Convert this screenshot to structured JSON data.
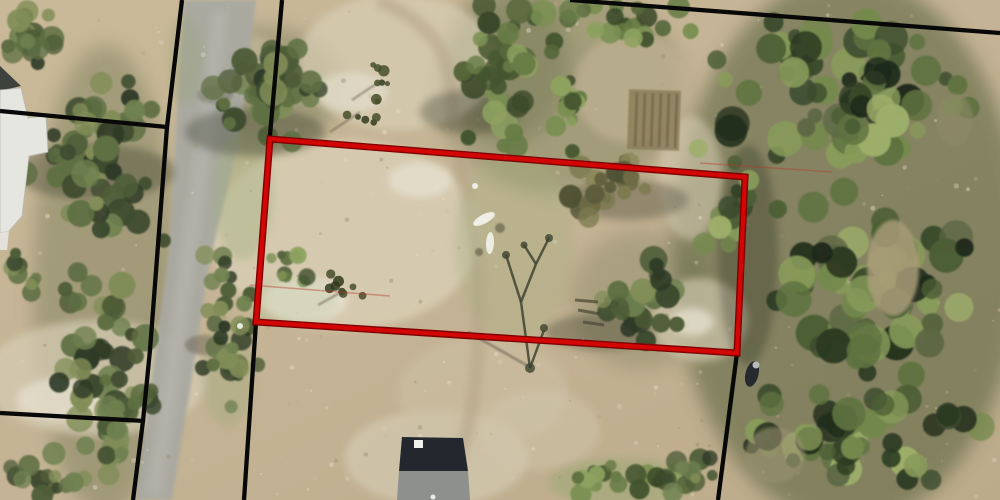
{
  "palette": {
    "P1": [
      "#2E3A26",
      "#3D4B2E",
      "#4E5D38",
      "#5E6F42",
      "#6F8150",
      "#828E58"
    ],
    "P2": [
      "#44552F",
      "#56683A",
      "#687C46",
      "#7B9052",
      "#8EA260",
      "#3A4829"
    ],
    "P3": [
      "#1F2B1B",
      "#2C3A22",
      "#3A4A2C",
      "#4C5E34",
      "#5F7340",
      "#74894C",
      "#889C5A",
      "#9DAF6A",
      "#5C6644"
    ],
    "P4": [
      "#6E6B46",
      "#7D7A50",
      "#5C5C3C",
      "#8B8658",
      "#4E5234"
    ],
    "base_stops": [
      "#C9B998",
      "#C4B394",
      "#BCAB8A"
    ],
    "road": "#A9A9A1",
    "road_stripe": "#BABAB2",
    "trail": "#B3A286",
    "black_line": "#080808",
    "red_outline": "#D40505",
    "red_outline_dark": "#7E0202",
    "thin_red": "#B53A30",
    "speckle_colors": [
      "#E7E1CF",
      "#B2A487",
      "#D9CEB5",
      "#9C9076",
      "#C8BCA0"
    ]
  },
  "map": {
    "canvas": {
      "width": 1000,
      "height": 500
    },
    "washes": [
      [
        848,
        250,
        175,
        275,
        "#4A5733",
        0.5
      ],
      [
        105,
        280,
        72,
        235,
        "#5A6640",
        0.33
      ],
      [
        560,
        90,
        125,
        105,
        "#5E6C42",
        0.32
      ],
      [
        265,
        88,
        78,
        62,
        "#50603A",
        0.3
      ],
      [
        508,
        62,
        62,
        82,
        "#4E5C38",
        0.28
      ],
      [
        640,
        300,
        70,
        70,
        "#56633C",
        0.22
      ]
    ],
    "sand_patches": [
      [
        345,
        235,
        135,
        95,
        "#DBD1B8",
        0.75
      ],
      [
        398,
        62,
        100,
        68,
        "#D8CEB5",
        0.7
      ],
      [
        96,
        378,
        112,
        58,
        "#D7CDB5",
        0.7
      ],
      [
        436,
        458,
        92,
        48,
        "#D3C9B1",
        0.7
      ],
      [
        700,
        320,
        48,
        42,
        "#D5CBB2",
        0.65
      ],
      [
        690,
        178,
        32,
        62,
        "#D2C8AF",
        0.6
      ],
      [
        483,
        392,
        85,
        55,
        "#CDC1A6",
        0.55
      ],
      [
        632,
        88,
        58,
        55,
        "#C4B596",
        0.6
      ],
      [
        305,
        300,
        42,
        22,
        "#EAE5D5",
        0.8
      ],
      [
        420,
        180,
        32,
        18,
        "#E8E3D3",
        0.7
      ],
      [
        352,
        92,
        36,
        20,
        "#E5E0CF",
        0.65
      ],
      [
        62,
        400,
        46,
        22,
        "#E7E2D1",
        0.7
      ],
      [
        692,
        322,
        22,
        14,
        "#EBE6D7",
        0.7
      ],
      [
        540,
        430,
        60,
        40,
        "#D0C5AB",
        0.5
      ],
      [
        245,
        60,
        40,
        25,
        "#CFC3A8",
        0.5
      ]
    ],
    "road": {
      "polygon": [
        [
          184,
          0
        ],
        [
          256,
          0
        ],
        [
          240,
          137
        ],
        [
          210,
          260
        ],
        [
          190,
          390
        ],
        [
          172,
          500
        ],
        [
          136,
          500
        ],
        [
          152,
          380
        ],
        [
          169,
          250
        ],
        [
          176,
          130
        ]
      ],
      "stripe_path": "M220,10 C212,90 196,200 182,300 C172,380 162,440 154,495",
      "shadow_blobs": [
        [
          205,
          345,
          20,
          10,
          "#6A6456",
          0.5
        ],
        [
          215,
          95,
          18,
          9,
          "#74705F",
          0.45
        ]
      ]
    },
    "trail": {
      "path": "M378,0 C428,22 450,48 452,96 C454,140 463,172 470,212 C478,252 481,300 478,350 C475,400 468,440 452,472"
    },
    "speckles": {
      "count": 320,
      "seed": 999,
      "rmin": 0.8,
      "rmax": 2.6,
      "opacity": 0.45
    },
    "grass": [
      [
        243,
        195,
        30,
        65,
        "#9FAF7E",
        0.4
      ],
      [
        228,
        372,
        26,
        55,
        "#9AA87A",
        0.35
      ],
      [
        514,
        245,
        60,
        95,
        "#A3B180",
        0.3
      ],
      [
        620,
        482,
        72,
        24,
        "#8FA46C",
        0.4
      ],
      [
        292,
        302,
        46,
        25,
        "#B7C49A",
        0.3
      ],
      [
        185,
        60,
        18,
        45,
        "#97A476",
        0.3
      ]
    ],
    "garden_plot": {
      "x": 628,
      "y": 90,
      "w": 52,
      "h": 60,
      "rot": 2,
      "cx": 654,
      "cy": 120,
      "fill": "#8A7C59",
      "opacity": 0.8,
      "stripe_color": "#6C5F41",
      "stripe_xs": [
        636,
        644,
        652,
        660,
        668,
        676
      ]
    },
    "cluster_shadows": [
      [
        255,
        132,
        70,
        24
      ],
      [
        95,
        172,
        80,
        28
      ],
      [
        470,
        112,
        50,
        22
      ],
      [
        600,
        332,
        55,
        18
      ],
      [
        748,
        255,
        30,
        110
      ],
      [
        628,
        200,
        60,
        20
      ]
    ],
    "shadow_color": "#262B1C",
    "tree_clusters": [
      {
        "name": "topleft-corner",
        "bx": 0,
        "by": 0,
        "bw": 58,
        "bh": 74,
        "n": 20,
        "rmin": 6,
        "rmax": 13,
        "pal": "P1",
        "seed": 11
      },
      {
        "name": "left-of-building",
        "bx": 22,
        "by": 70,
        "bw": 150,
        "bh": 186,
        "n": 56,
        "rmin": 6,
        "rmax": 15,
        "pal": "P1",
        "seed": 22
      },
      {
        "name": "left-road-strip",
        "bx": 50,
        "by": 246,
        "bw": 110,
        "bh": 254,
        "n": 64,
        "rmin": 6,
        "rmax": 14,
        "pal": "P1",
        "seed": 33
      },
      {
        "name": "right-of-road-top",
        "bx": 203,
        "by": 36,
        "bw": 130,
        "bh": 110,
        "n": 42,
        "rmin": 6,
        "rmax": 14,
        "pal": "P1",
        "seed": 44
      },
      {
        "name": "roadside-mid",
        "bx": 196,
        "by": 243,
        "bw": 64,
        "bh": 182,
        "n": 34,
        "rmin": 5,
        "rmax": 12,
        "pal": "P1",
        "seed": 55
      },
      {
        "name": "parcel-left-scrub",
        "bx": 262,
        "by": 246,
        "bw": 60,
        "bh": 44,
        "n": 10,
        "rmin": 4,
        "rmax": 9,
        "pal": "P2",
        "seed": 50
      },
      {
        "name": "top-center-column",
        "bx": 456,
        "by": 0,
        "bw": 110,
        "bh": 150,
        "n": 44,
        "rmin": 6,
        "rmax": 14,
        "pal": "P2",
        "seed": 66
      },
      {
        "name": "top-band",
        "bx": 556,
        "by": 0,
        "bw": 160,
        "bh": 52,
        "n": 22,
        "rmin": 6,
        "rmax": 13,
        "pal": "P2",
        "seed": 77
      },
      {
        "name": "clearing-left-trees",
        "bx": 552,
        "by": 25,
        "bw": 42,
        "bh": 158,
        "n": 16,
        "rmin": 5,
        "rmax": 11,
        "pal": "P2",
        "seed": 78
      },
      {
        "name": "parcel-brown-trees",
        "bx": 550,
        "by": 150,
        "bw": 106,
        "bh": 86,
        "n": 22,
        "rmin": 5,
        "rmax": 12,
        "pal": "P4",
        "seed": 88
      },
      {
        "name": "parcel-center-tree",
        "bx": 583,
        "by": 243,
        "bw": 110,
        "bh": 112,
        "n": 28,
        "rmin": 6,
        "rmax": 14,
        "pal": "P1",
        "seed": 99
      },
      {
        "name": "bottom-center-green",
        "bx": 553,
        "by": 462,
        "bw": 138,
        "bh": 38,
        "n": 20,
        "rmin": 5,
        "rmax": 11,
        "pal": "P2",
        "seed": 111
      },
      {
        "name": "bottom-left-trees",
        "bx": 0,
        "by": 462,
        "bw": 88,
        "bh": 38,
        "n": 13,
        "rmin": 5,
        "rmax": 11,
        "pal": "P1",
        "seed": 122
      },
      {
        "name": "left-edge-tree",
        "bx": 0,
        "by": 246,
        "bw": 42,
        "bh": 58,
        "n": 9,
        "rmin": 5,
        "rmax": 10,
        "pal": "P1",
        "seed": 133
      },
      {
        "name": "dirt-strip-trees",
        "bx": 658,
        "by": 446,
        "bw": 64,
        "bh": 54,
        "n": 12,
        "rmin": 5,
        "rmax": 11,
        "pal": "P1",
        "seed": 144
      },
      {
        "name": "forest-notch",
        "bx": 700,
        "by": 185,
        "bw": 62,
        "bh": 70,
        "n": 12,
        "rmin": 6,
        "rmax": 12,
        "pal": "P3",
        "seed": 188
      },
      {
        "name": "forest-top",
        "bx": 688,
        "by": 0,
        "bw": 312,
        "bh": 185,
        "n": 72,
        "rmin": 7,
        "rmax": 18,
        "pal": "P3",
        "seed": 155
      },
      {
        "name": "forest-mid",
        "bx": 758,
        "by": 180,
        "bw": 242,
        "bh": 215,
        "n": 62,
        "rmin": 7,
        "rmax": 19,
        "pal": "P3",
        "seed": 166
      },
      {
        "name": "forest-bottom",
        "bx": 735,
        "by": 385,
        "bw": 265,
        "bh": 115,
        "n": 48,
        "rmin": 7,
        "rmax": 17,
        "pal": "P3",
        "seed": 177
      }
    ],
    "forest_gaps": [
      [
        893,
        268,
        26,
        48,
        "#A89B78",
        0.85
      ],
      [
        955,
        120,
        18,
        26,
        "#8F8A68",
        0.6
      ],
      [
        775,
        455,
        30,
        28,
        "#97906F",
        0.6
      ]
    ],
    "scrubs": [
      {
        "cx": 384,
        "cy": 76,
        "spread": 14,
        "n": 6,
        "seed": 301,
        "shadow": [
          352,
          100,
          382,
          80
        ]
      },
      {
        "cx": 363,
        "cy": 110,
        "spread": 16,
        "n": 7,
        "seed": 302,
        "shadow": [
          330,
          132,
          360,
          112
        ]
      },
      {
        "cx": 347,
        "cy": 287,
        "spread": 18,
        "n": 8,
        "seed": 303,
        "shadow": [
          318,
          305,
          345,
          290
        ]
      }
    ],
    "scrub_colors": [
      "#33391F",
      "#454D2A"
    ],
    "dead_tree": {
      "branches": [
        "M530,368 L521,302",
        "M521,302 L506,255",
        "M521,302 L536,264",
        "M536,264 L549,238",
        "M536,264 L524,245",
        "M530,368 L544,330"
      ],
      "blobs": [
        [
          506,
          255,
          4
        ],
        [
          549,
          238,
          4
        ],
        [
          524,
          245,
          3.5
        ],
        [
          544,
          328,
          4
        ],
        [
          530,
          368,
          5
        ]
      ],
      "shadow": [
        468,
        332,
        528,
        366
      ],
      "color": "#3F4430"
    },
    "debris_strokes": [
      [
        575,
        300,
        598,
        302
      ],
      [
        578,
        310,
        600,
        314
      ],
      [
        583,
        322,
        604,
        325
      ]
    ],
    "debris_color": "#4A4636",
    "buildings": {
      "left_roof_dark": [
        [
          0,
          66
        ],
        [
          21,
          86
        ],
        [
          0,
          91
        ]
      ],
      "left_roof_main": [
        [
          0,
          90
        ],
        [
          21,
          88
        ],
        [
          28,
          118
        ],
        [
          46,
          116
        ],
        [
          48,
          152
        ],
        [
          29,
          156
        ],
        [
          22,
          216
        ],
        [
          9,
          231
        ],
        [
          0,
          233
        ]
      ],
      "left_roof_lower": [
        [
          0,
          233
        ],
        [
          9,
          231
        ],
        [
          7,
          250
        ],
        [
          0,
          250
        ]
      ],
      "roof_fill": "#E6E6E0",
      "roof_stroke": "#B9B9B2",
      "dark_fill": "#3E423C",
      "house_dark": [
        [
          402,
          437
        ],
        [
          463,
          438
        ],
        [
          468,
          471
        ],
        [
          399,
          471
        ]
      ],
      "house_gray": [
        [
          399,
          471
        ],
        [
          468,
          471
        ],
        [
          470,
          500
        ],
        [
          397,
          500
        ]
      ],
      "house_dark_fill": "#23272E",
      "house_gray_fill": "#8D908C",
      "vent": {
        "x": 414,
        "y": 440,
        "w": 9,
        "h": 8,
        "fill": "#F2F2EC"
      }
    },
    "objects": {
      "boats": [
        {
          "cx": 484,
          "cy": 219,
          "rx": 12,
          "ry": 4.5,
          "rot": -28,
          "fill": "#EFEFE6"
        },
        {
          "cx": 490,
          "cy": 243,
          "rx": 4,
          "ry": 11,
          "rot": 3,
          "fill": "#ECECE2"
        }
      ],
      "boat_shadows": [
        [
          500,
          228,
          5
        ],
        [
          479,
          252,
          4
        ]
      ],
      "boat_shadow_color": "#3E3A2E",
      "white_dots": [
        [
          475,
          186,
          3
        ],
        [
          240,
          326,
          3
        ],
        [
          433,
          497,
          2.5
        ]
      ],
      "vehicle": {
        "cx": 752,
        "cy": 374,
        "rx": 6.5,
        "ry": 13,
        "rot": 14,
        "fill": "#26292E",
        "hl_cx": 756,
        "hl_cy": 365,
        "hl_r": 3.5,
        "hl_fill": "#B9BCB8"
      }
    },
    "parcel_lines_black": {
      "width": 4.3,
      "lines": [
        [
          [
            182,
            0
          ],
          [
            167,
            127
          ],
          [
            150,
            350
          ],
          [
            143,
            421
          ],
          [
            133,
            500
          ]
        ],
        [
          [
            0,
            111
          ],
          [
            167,
            127
          ]
        ],
        [
          [
            0,
            413
          ],
          [
            145,
            421
          ]
        ],
        [
          [
            282,
            0
          ],
          [
            270,
            135
          ],
          [
            256,
            322
          ],
          [
            244,
            500
          ]
        ],
        [
          [
            570,
            0
          ],
          [
            1000,
            33
          ]
        ],
        [
          [
            737,
            353
          ],
          [
            718,
            500
          ]
        ]
      ]
    },
    "parcel_lines_thin_red": {
      "width": 1.6,
      "opacity": 0.42,
      "lines": [
        [
          [
            250,
            285
          ],
          [
            390,
            296
          ]
        ],
        [
          [
            700,
            163
          ],
          [
            832,
            172
          ]
        ]
      ]
    },
    "selected_parcel": {
      "points": [
        [
          270,
          139
        ],
        [
          745,
          177
        ],
        [
          737,
          353
        ],
        [
          256,
          322
        ]
      ],
      "stroke_width": 4.2,
      "rim_width": 7
    }
  }
}
